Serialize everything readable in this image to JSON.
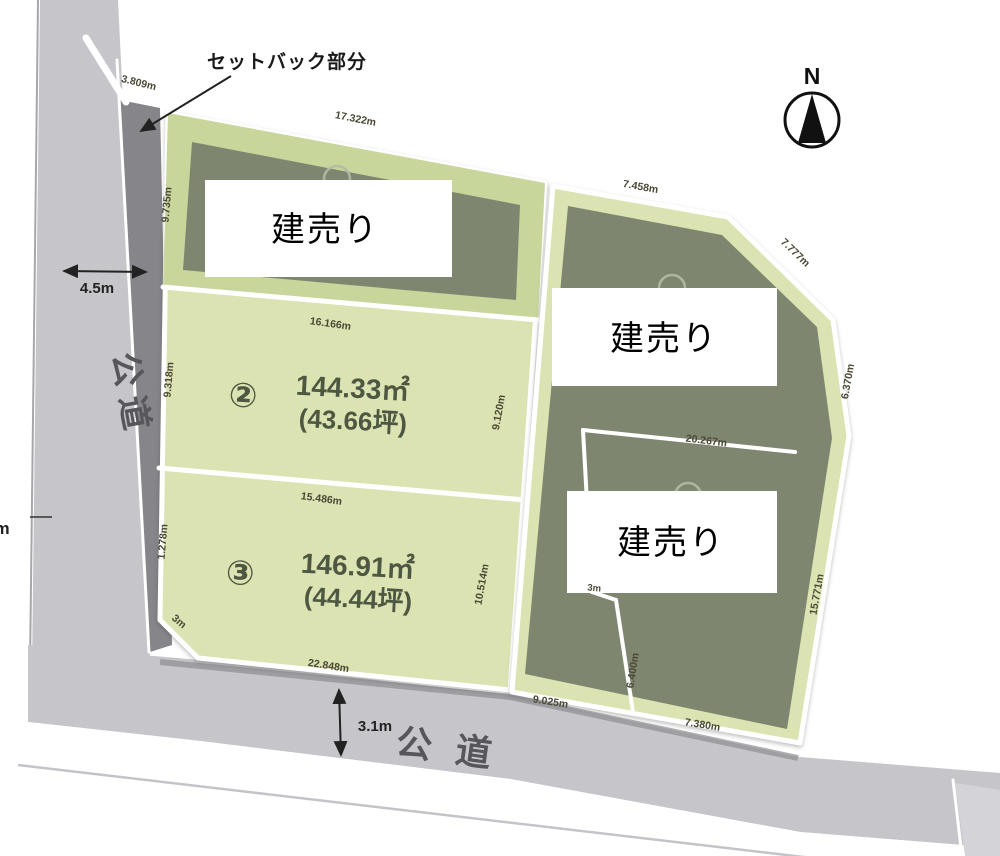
{
  "labels": {
    "setback_note": "セットバック部分",
    "road_left": "公道",
    "road_bottom": "公道",
    "road_left_width": "4.5m",
    "road_bottom_width": "3.1m",
    "compass_north": "N",
    "left_edge_partial": "m"
  },
  "plots": {
    "plot1": {
      "overlay_label": "建売り",
      "dim_top": "17.322m",
      "dim_left": "9.735m",
      "dim_setback": "3.809m"
    },
    "plot2": {
      "number": "②",
      "area_sqm": "144.33㎡",
      "area_tsubo": "(43.66坪)",
      "dim_top": "16.166m",
      "dim_left": "9.318m",
      "dim_right": "9.120m"
    },
    "plot3": {
      "number": "③",
      "area_sqm": "146.91㎡",
      "area_tsubo": "(44.44坪)",
      "dim_top": "15.486m",
      "dim_left": "1.278m",
      "dim_right": "10.514m",
      "dim_bottom": "22.848m",
      "dim_chamfer": "3m"
    },
    "plot_right_top": {
      "overlay_label": "建売り",
      "dim_top": "7.458m",
      "dim_diagonal": "7.777m",
      "dim_right": "6.370m"
    },
    "plot_right_bottom": {
      "overlay_label": "建売り",
      "dim_top": "20.267m",
      "dim_right": "15.771m",
      "dim_bottom_left": "9.025m",
      "dim_bottom_right": "7.380m",
      "dim_inner": "6.400m",
      "dim_step": "3m"
    }
  },
  "colors": {
    "page_bg": "#ffffff",
    "road_gray": "#c6c6ca",
    "road_gray_light": "#d4d4d8",
    "setback_gray": "#85858a",
    "green_light": "#dce3b2",
    "green_mid": "#c8d59b",
    "building_olive": "#7e8670",
    "line_white": "#ffffff",
    "dim_text": "#4b4936",
    "area_text": "#4d5741",
    "road_text": "#57575b",
    "black_text": "#1a1a1a"
  }
}
